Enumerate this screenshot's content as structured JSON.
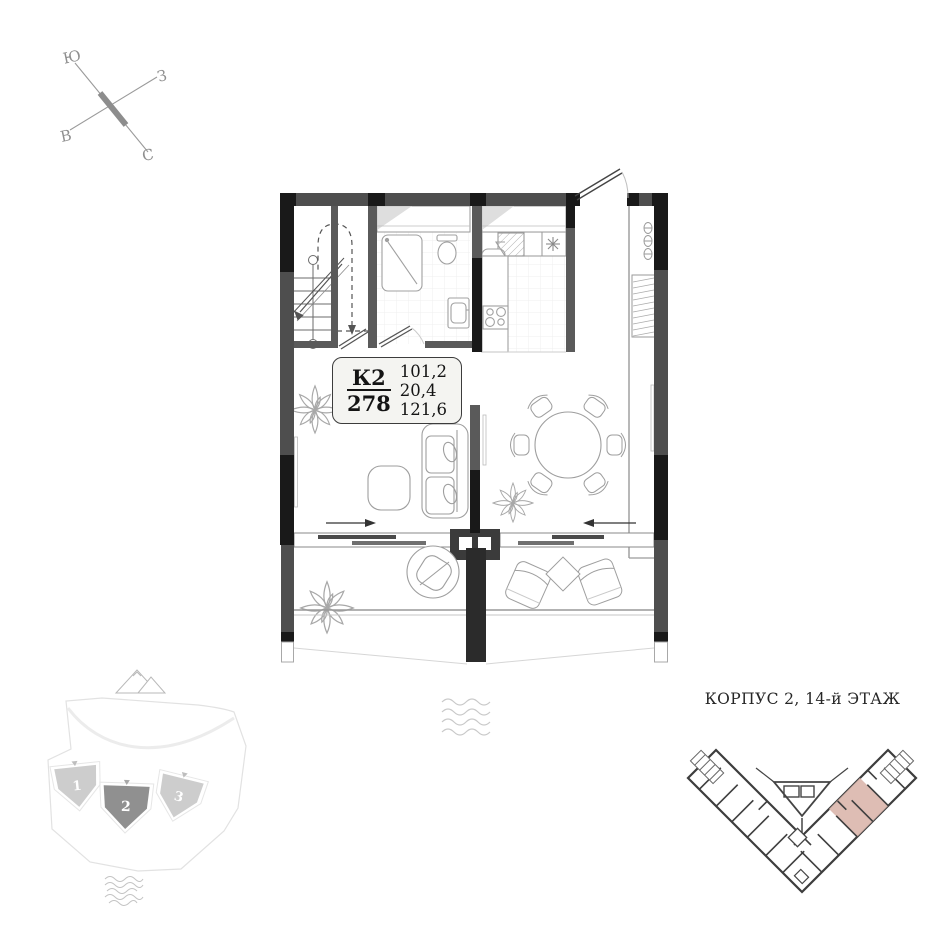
{
  "compass": {
    "top_left": "Ю",
    "right": "З",
    "bottom_left": "В",
    "bottom_right": "С"
  },
  "apartment_card": {
    "building": "К2",
    "number": "278",
    "areas": [
      "101,2",
      "20,4",
      "121,6"
    ]
  },
  "site_plan": {
    "building_labels": [
      "1",
      "2",
      "3"
    ],
    "highlighted_building": "2"
  },
  "minimap": {
    "title": "КОРПУС 2, 14-й ЭТАЖ"
  },
  "colors": {
    "wall_black": "#191919",
    "wall_gray": "#4e4e4e",
    "partition_gray": "#5a5a5a",
    "fixture_gray": "#a0a0a0",
    "highlight_unit_pink": "#dcb9b0",
    "building_highlight": "#909090",
    "building_normal": "#cdcdcd"
  }
}
